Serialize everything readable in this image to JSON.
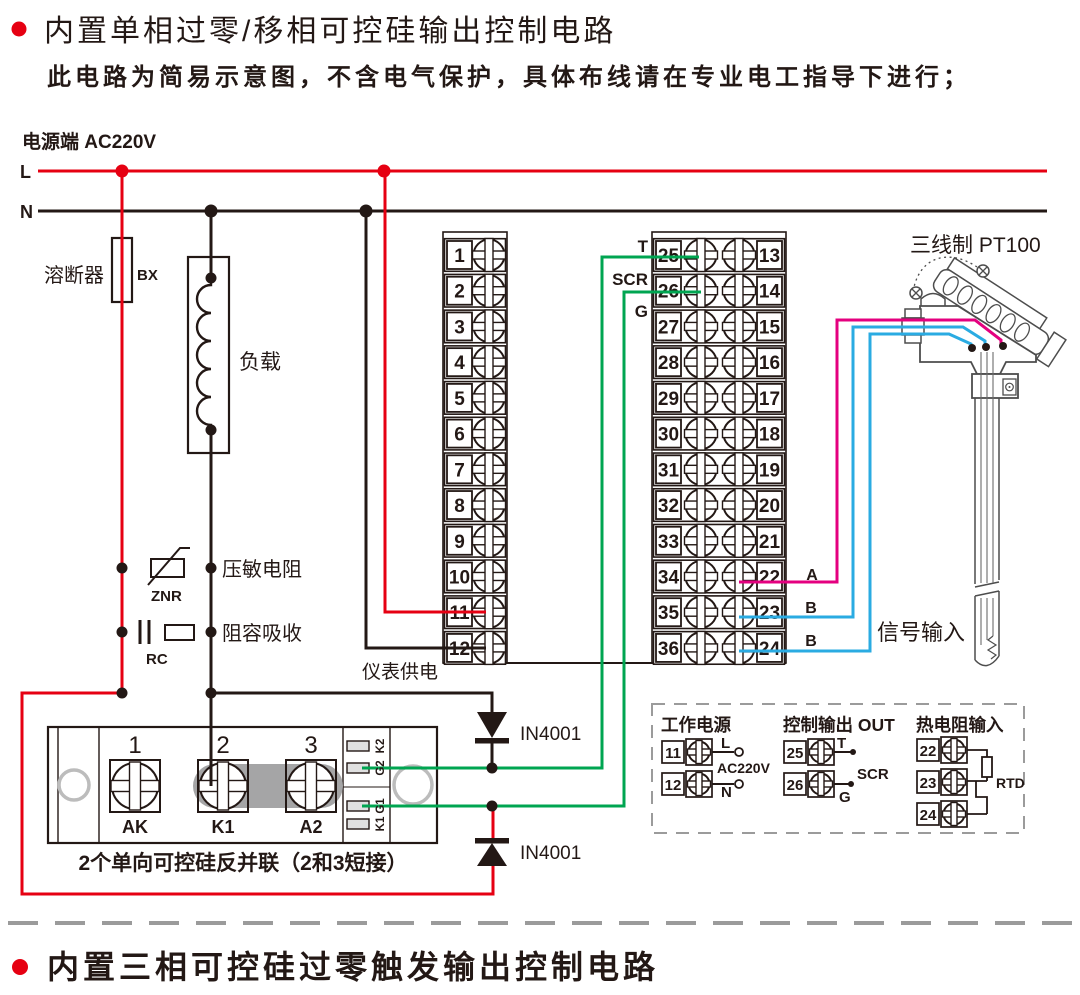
{
  "header": {
    "title": "内置单相过零/移相可控硅输出控制电路",
    "subtitle": "此电路为简易示意图，不含电气保护，具体布线请在专业电工指导下进行；"
  },
  "footer": {
    "title": "内置三相可控硅过零触发输出控制电路"
  },
  "power": {
    "label": "电源端  AC220V",
    "line_l": "L",
    "line_n": "N"
  },
  "components": {
    "fuse_name": "溶断器",
    "fuse_code": "BX",
    "load_name": "负载",
    "varistor_name": "压敏电阻",
    "varistor_code": "ZNR",
    "snubber_name": "阻容吸收",
    "snubber_code": "RC",
    "meter_supply_label": "仪表供电",
    "diode_top_label": "IN4001",
    "diode_bottom_label": "IN4001"
  },
  "scr_module": {
    "terminal_numbers": [
      "1",
      "2",
      "3"
    ],
    "terminal_names": [
      "AK",
      "K1",
      "A2"
    ],
    "side_pins": [
      "K2",
      "G2",
      "G1",
      "K1"
    ],
    "caption": "2个单向可控硅反并联（2和3短接）"
  },
  "terminal_strip": {
    "left_numbers": [
      "1",
      "2",
      "3",
      "4",
      "5",
      "6",
      "7",
      "8",
      "9",
      "10",
      "11",
      "12"
    ],
    "right_inner_numbers": [
      "25",
      "26",
      "27",
      "28",
      "29",
      "30",
      "31",
      "32",
      "33",
      "34",
      "35",
      "36"
    ],
    "right_outer_numbers": [
      "13",
      "14",
      "15",
      "16",
      "17",
      "18",
      "19",
      "20",
      "21",
      "22",
      "23",
      "24"
    ],
    "output_pin_labels": [
      "T",
      "SCR",
      "G"
    ]
  },
  "sensor": {
    "title": "三线制 PT100",
    "signal_label": "信号输入",
    "wire_labels": [
      "A",
      "B",
      "B"
    ]
  },
  "detail_box": {
    "power": {
      "title": "工作电源",
      "terminals": [
        "11",
        "12"
      ],
      "pin_labels": [
        "L",
        "N"
      ],
      "voltage": "AC220V"
    },
    "output": {
      "title": "控制输出 OUT",
      "terminals": [
        "25",
        "26"
      ],
      "pin_labels": [
        "T",
        "SCR",
        "G"
      ]
    },
    "rtd": {
      "title": "热电阻输入",
      "terminals": [
        "22",
        "23",
        "24"
      ],
      "code": "RTD"
    }
  },
  "colors": {
    "wire_red": "#e60012",
    "wire_black": "#231815",
    "wire_green": "#00a551",
    "wire_cyan": "#2aabe2",
    "wire_magenta": "#e4007f",
    "dash_gray": "#9b9b9b"
  }
}
